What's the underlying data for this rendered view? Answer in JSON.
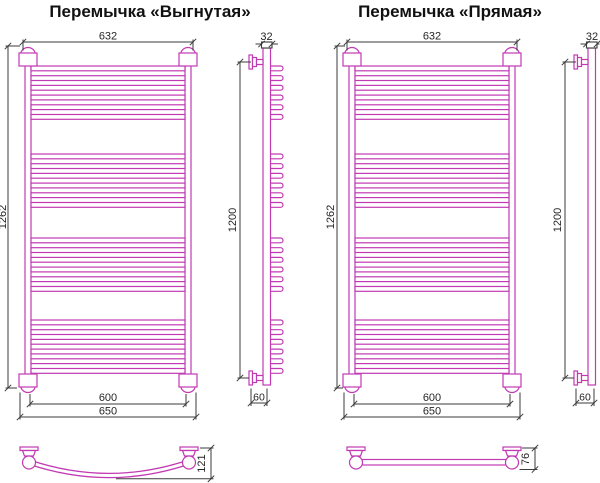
{
  "colors": {
    "product_line": "#c13ab3",
    "dimension_line": "#3b3b3b"
  },
  "left": {
    "title": "Перемычка «Выгнутая»",
    "front": {
      "top_width": "632",
      "height": "1262",
      "inner_width": "600",
      "outer_width": "650"
    },
    "side": {
      "pipe_width": "32",
      "height": "1200",
      "wall_depth": "60"
    },
    "crossbar": {
      "depth": "121"
    }
  },
  "right": {
    "title": "Перемычка «Прямая»",
    "front": {
      "top_width": "632",
      "height": "1262",
      "inner_width": "600",
      "outer_width": "650"
    },
    "side": {
      "pipe_width": "32",
      "height": "1200",
      "wall_depth": "60"
    },
    "crossbar": {
      "depth": "76"
    }
  }
}
